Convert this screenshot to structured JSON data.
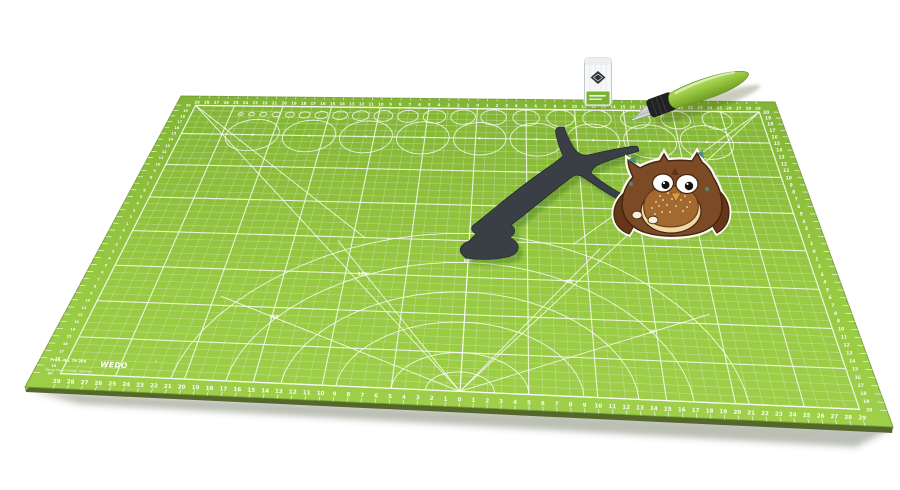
{
  "window": {
    "background": "#ffffff",
    "width": 900,
    "height": 490
  },
  "mat": {
    "brand": "WEDO",
    "brand_reg": "®",
    "prod_no": "Prod.-No. 79 260",
    "company_line": "Werner Dorsch GmbH · Germany",
    "angle_labels": [
      "30°",
      "60°",
      "90°",
      "120°",
      "150°"
    ],
    "ruler_horizontal": [
      29,
      28,
      27,
      26,
      25,
      24,
      23,
      22,
      21,
      20,
      19,
      18,
      17,
      16,
      15,
      14,
      13,
      12,
      11,
      10,
      9,
      8,
      7,
      6,
      5,
      4,
      3,
      2,
      1,
      0,
      1,
      2,
      3,
      4,
      5,
      6,
      7,
      8,
      9,
      10,
      11,
      12,
      13,
      14,
      15,
      16,
      17,
      18,
      19,
      20,
      21,
      22,
      23,
      24,
      25,
      26,
      27,
      28,
      29
    ],
    "ruler_vertical": [
      20,
      19,
      18,
      17,
      16,
      15,
      14,
      13,
      12,
      11,
      10,
      9,
      8,
      7,
      6,
      5,
      4,
      3,
      2,
      1,
      0,
      1,
      2,
      3,
      4,
      5,
      6,
      7,
      8,
      9,
      10,
      11,
      12,
      13,
      14,
      15,
      16,
      17,
      18,
      19,
      20
    ],
    "colors": {
      "surface_top": "#83b536",
      "surface_bottom": "#a0d04b",
      "edge_side": "#55682c",
      "grid_minor": "rgba(255,255,255,0.32)",
      "grid_major": "rgba(255,255,255,0.78)",
      "marking": "rgba(255,255,255,0.85)",
      "number": "#ffffff"
    }
  },
  "tools": {
    "knife": {
      "handle": "#96c73e",
      "handle_dark": "#6f9c24",
      "grip": "#1f2123",
      "blade": "#d9dde1"
    },
    "blade_case": {
      "body": "#f6f8f9",
      "border": "#c2c7cb",
      "logo": "#2e3338",
      "label": "#7ab42f"
    }
  },
  "craft": {
    "branch": {
      "color": "#3a3f46"
    },
    "owl": {
      "body": "#7d4a26",
      "wing": "#653618",
      "outline": "#42260f",
      "belly": "#efd9a4",
      "chest": "#a4692e",
      "eye_white": "#ffffff",
      "pupil": "#15100c",
      "beak": "#e09a36",
      "accent": "#4e8d85",
      "feet": "#f8efdc"
    }
  }
}
